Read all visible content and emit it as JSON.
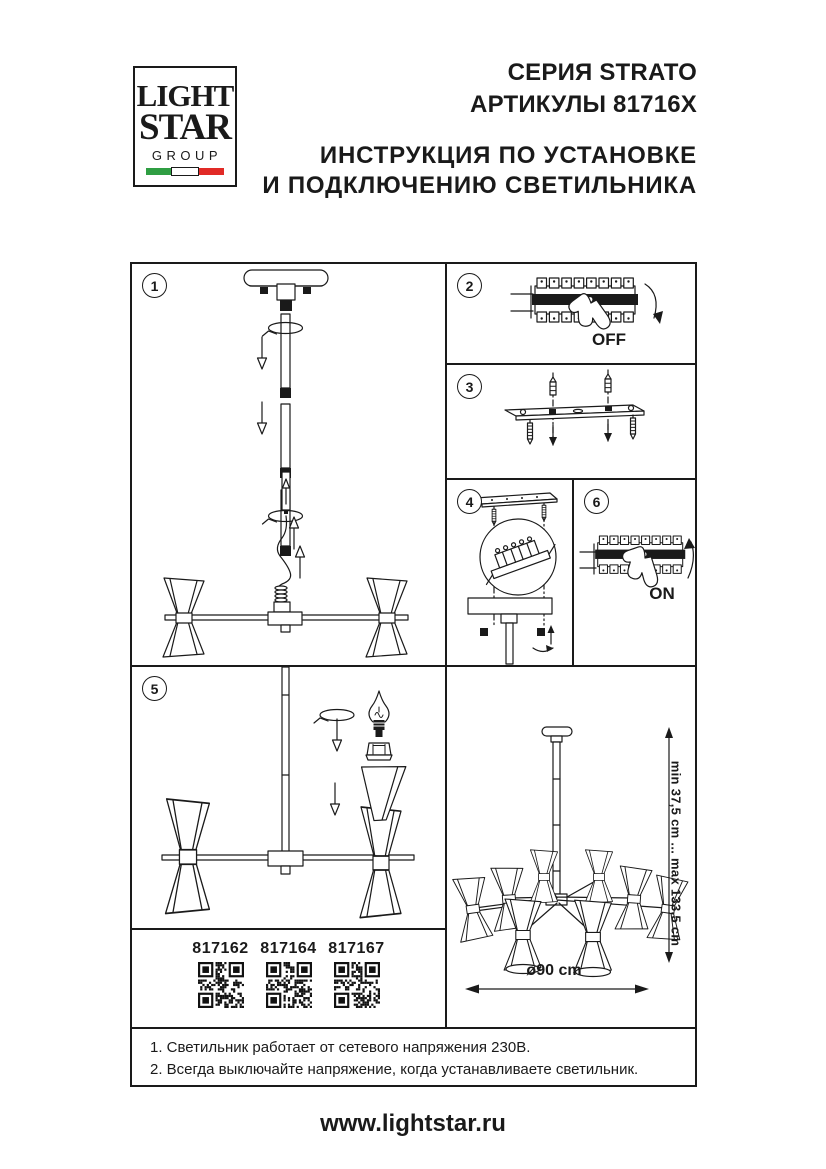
{
  "page": {
    "header": {
      "logo": {
        "word1": "LIGHT",
        "word2": "STAR",
        "word3": "GROUP"
      },
      "series": "СЕРИЯ STRATO",
      "articles": "АРТИКУЛЫ 81716X",
      "instruction_line1": "ИНСТРУКЦИЯ ПО УСТАНОВКЕ",
      "instruction_line2": "И ПОДКЛЮЧЕНИЮ СВЕТИЛЬНИКА"
    },
    "steps": {
      "s1": {
        "number": "1"
      },
      "s2": {
        "number": "2",
        "switch_label": "OFF"
      },
      "s3": {
        "number": "3"
      },
      "s4": {
        "number": "4"
      },
      "s5": {
        "number": "5"
      },
      "s6": {
        "number": "6",
        "switch_label": "ON"
      }
    },
    "qr_codes": [
      {
        "article": "817162"
      },
      {
        "article": "817164"
      },
      {
        "article": "817167"
      }
    ],
    "dimensions": {
      "height_range": "min 37,5 cm ... max 133,5 cm",
      "diameter": "ø90 cm"
    },
    "notes": {
      "line1": "1. Светильник работает от сетевого напряжения 230В.",
      "line2": "2. Всегда выключайте напряжение, когда устанавливаете светильник."
    },
    "website": "www.lightstar.ru",
    "colors": {
      "ink": "#1a1a1a",
      "flag_green": "#2f9e43",
      "flag_red": "#e12a26"
    }
  }
}
